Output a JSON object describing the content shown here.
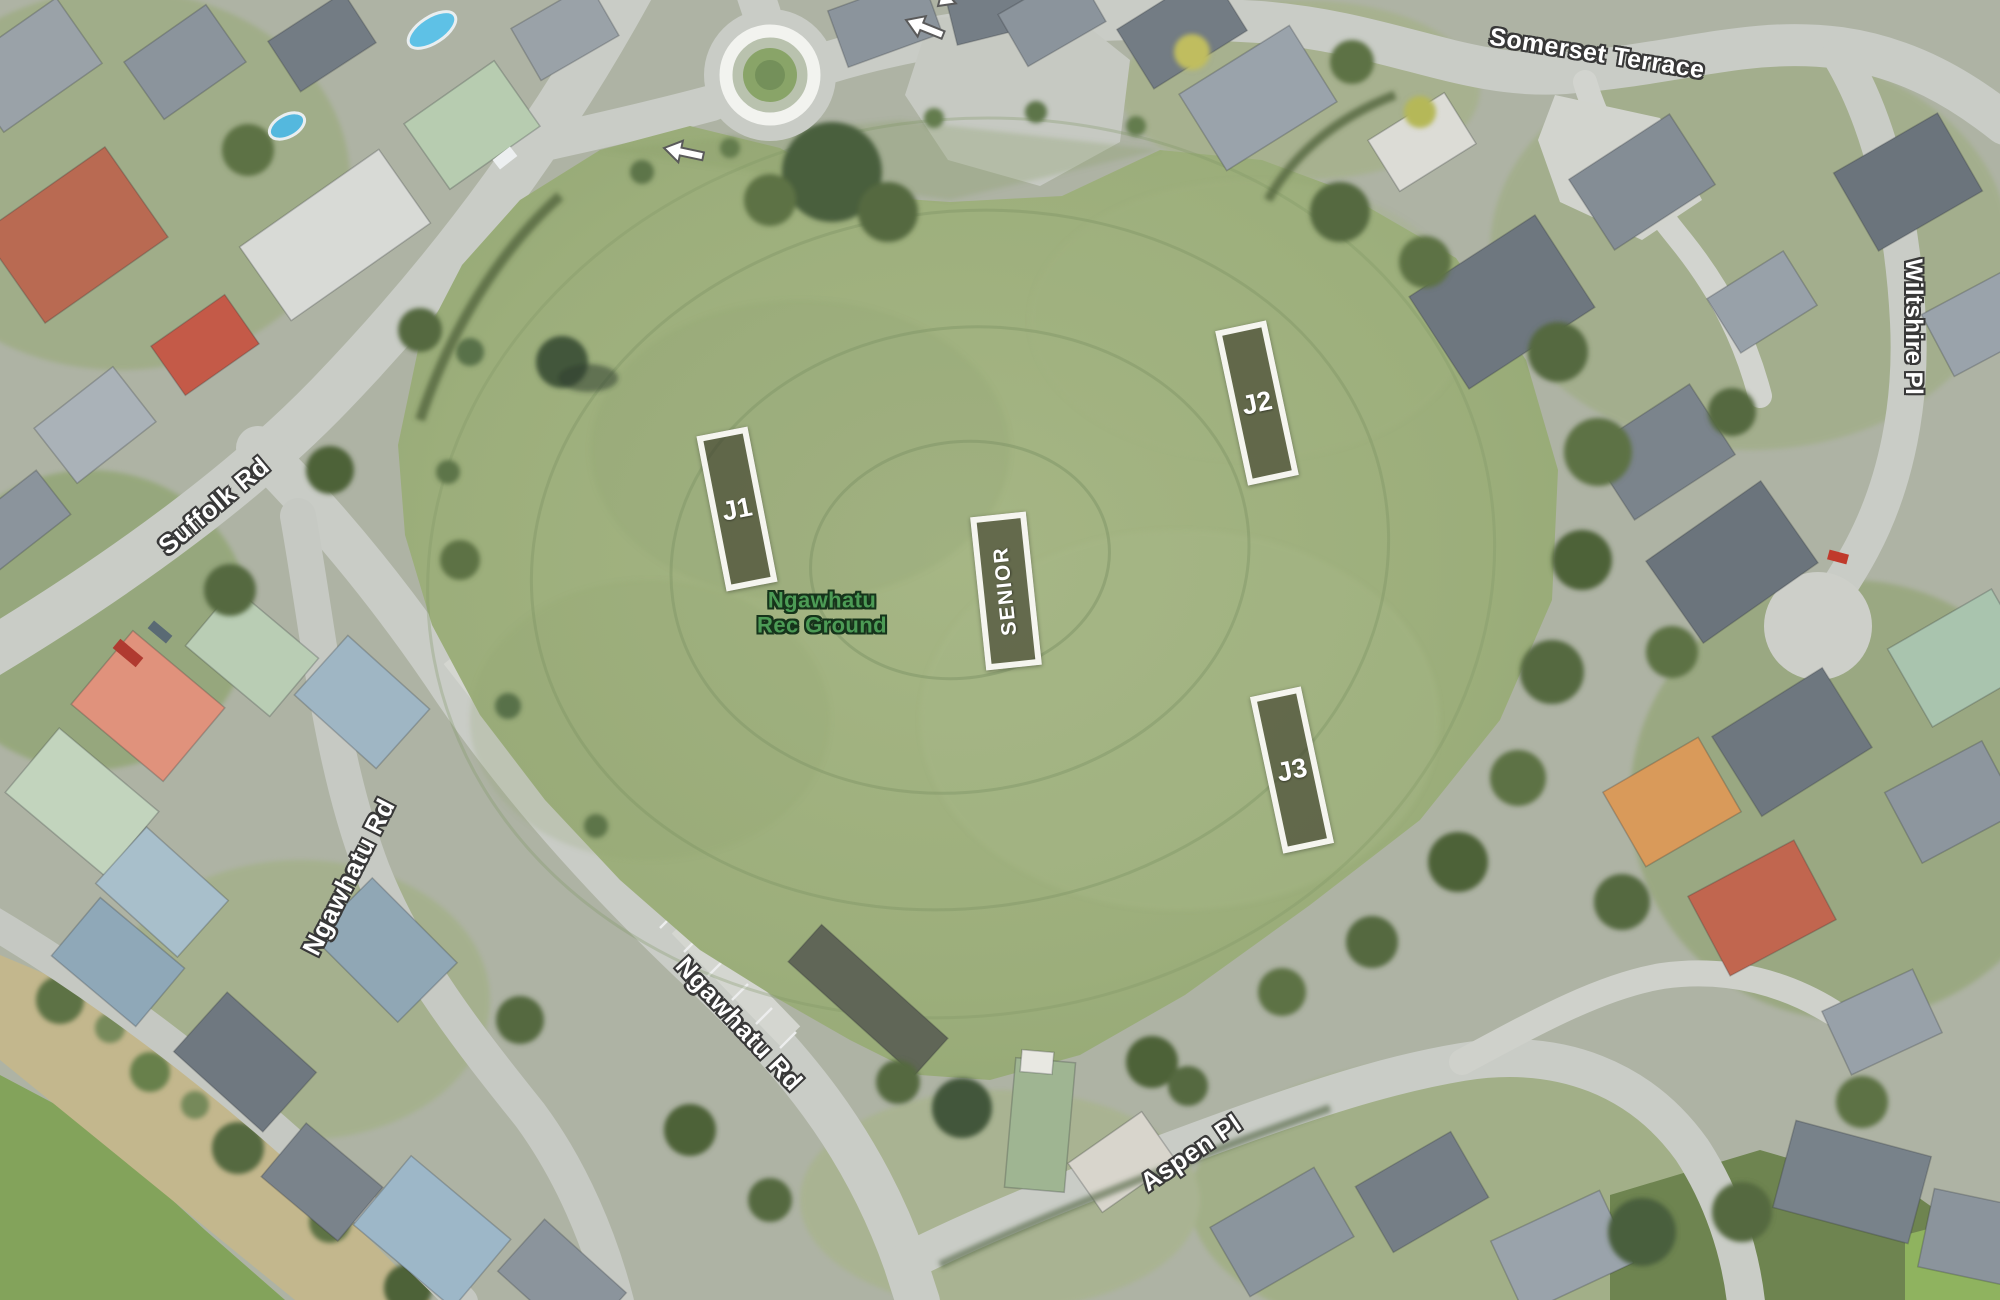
{
  "map": {
    "view": "satellite-aerial",
    "park": {
      "name_line1": "Ngawhatu",
      "name_line2": "Rec Ground",
      "label_color": "#4c9b55"
    },
    "pitches": [
      {
        "id": "j1",
        "label": "J1"
      },
      {
        "id": "j2",
        "label": "J2"
      },
      {
        "id": "j3",
        "label": "J3"
      },
      {
        "id": "senior",
        "label": "SENIOR"
      }
    ],
    "roads": [
      {
        "id": "somerset-terrace",
        "text": "Somerset Terrace"
      },
      {
        "id": "wiltshire-pl",
        "text": "Wiltshire Pl"
      },
      {
        "id": "suffolk-rd",
        "text": "Suffolk Rd"
      },
      {
        "id": "ngawhatu-rd-upper",
        "text": "Ngawhatu Rd"
      },
      {
        "id": "ngawhatu-rd-lower",
        "text": "Ngawhatu Rd"
      },
      {
        "id": "aspen-pl",
        "text": "Aspen Pl"
      }
    ],
    "annotations": {
      "icons": [
        "direction-arrow-icon",
        "direction-arrow-icon"
      ],
      "marker_border_color": "#f5f5ef",
      "marker_fill_color": "rgba(54,51,36,0.58)",
      "road_label_fill": "#ffffff",
      "road_label_outline": "#383838"
    },
    "colors": {
      "field_green": "#9fb07e",
      "road_gray": "#c9ccc6",
      "tree_green": "#5c7547",
      "paddock_green": "#83a35b"
    }
  }
}
